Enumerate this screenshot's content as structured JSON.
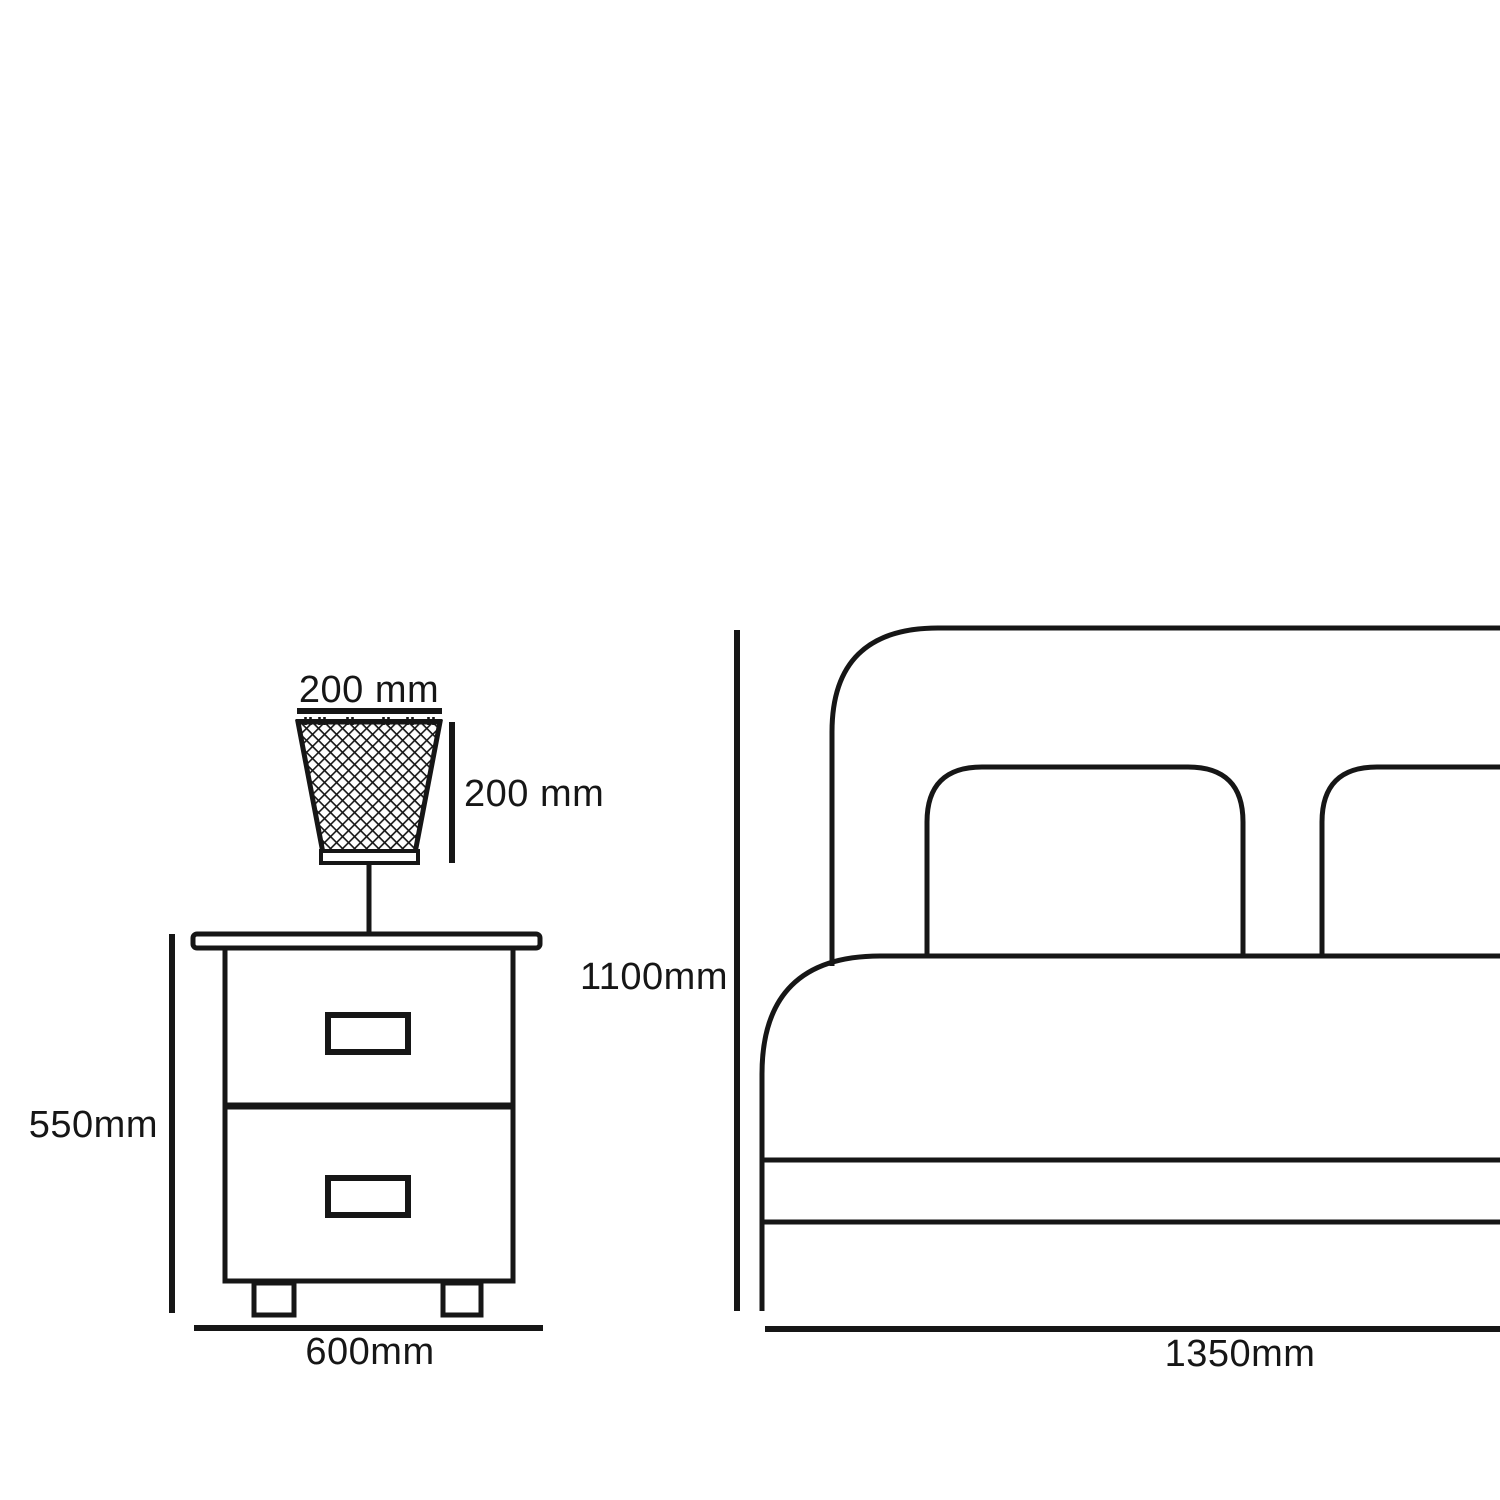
{
  "page": {
    "background_color": "#ffffff",
    "line_color": "#161616"
  },
  "diagram": {
    "kind": "furniture dimension drawing",
    "furniture": {
      "lamp": {
        "name": "table lamp with lattice shade",
        "width_label": "200 mm",
        "height_label": "200 mm"
      },
      "nightstand": {
        "name": "two-drawer nightstand",
        "height_label": "550mm",
        "width_label": "600mm",
        "drawer_count": 2
      },
      "bed": {
        "name": "bed with headboard and two pillows (cropped at right edge)",
        "height_label": "1100mm",
        "width_label": "1350mm"
      }
    }
  }
}
